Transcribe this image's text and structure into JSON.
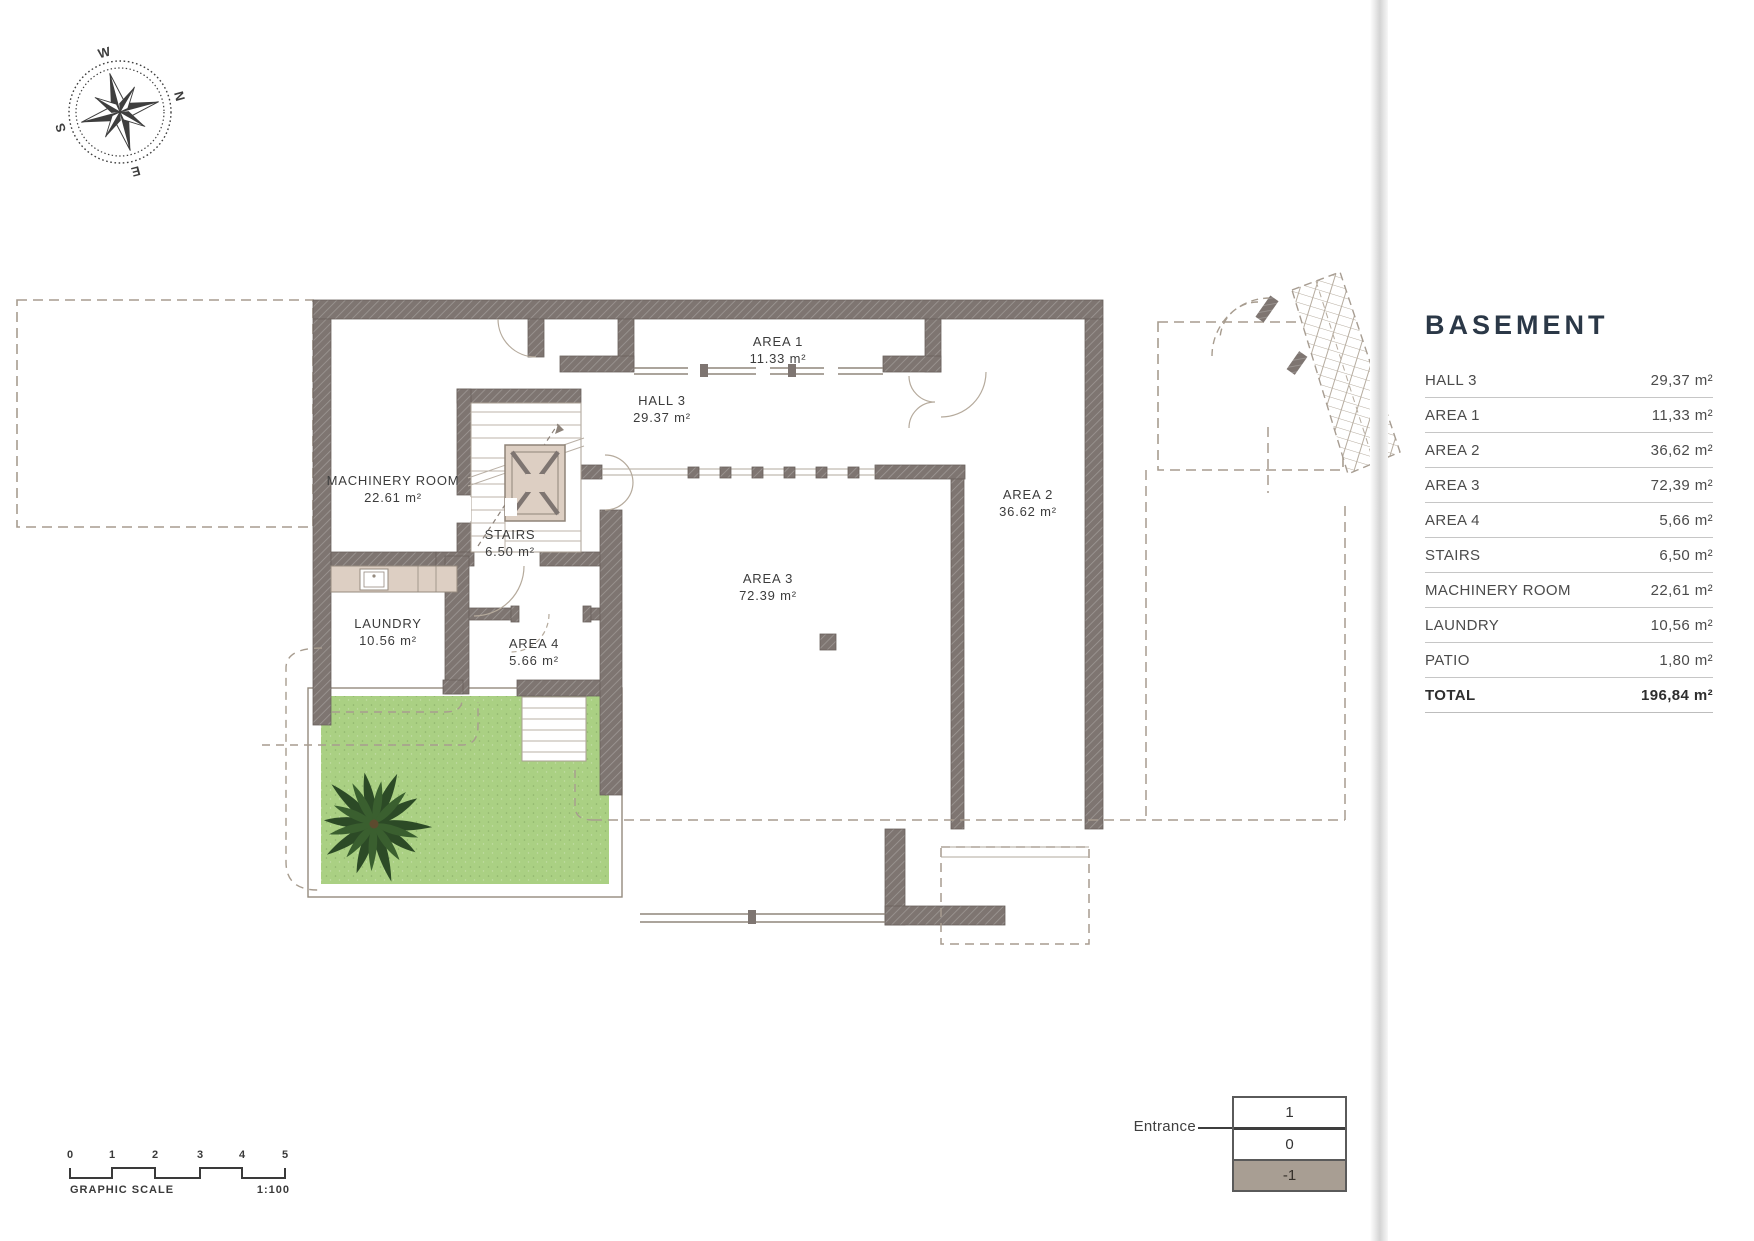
{
  "compass": {
    "n": "N",
    "e": "E",
    "s": "S",
    "w": "W"
  },
  "plan": {
    "rooms": [
      {
        "id": "machinery",
        "name": "MACHINERY ROOM",
        "area": "22.61 m²"
      },
      {
        "id": "hall3",
        "name": "HALL 3",
        "area": "29.37 m²"
      },
      {
        "id": "area1",
        "name": "AREA 1",
        "area": "11.33 m²"
      },
      {
        "id": "area2",
        "name": "AREA 2",
        "area": "36.62 m²"
      },
      {
        "id": "area3",
        "name": "AREA 3",
        "area": "72.39 m²"
      },
      {
        "id": "area4",
        "name": "AREA 4",
        "area": "5.66 m²"
      },
      {
        "id": "stairs",
        "name": "STAIRS",
        "area": "6.50 m²"
      },
      {
        "id": "laundry",
        "name": "LAUNDRY",
        "area": "10.56 m²"
      }
    ]
  },
  "legend": {
    "title": "BASEMENT",
    "rows": [
      {
        "label": "HALL 3",
        "value": "29,37 m²"
      },
      {
        "label": "AREA 1",
        "value": "11,33 m²"
      },
      {
        "label": "AREA 2",
        "value": "36,62 m²"
      },
      {
        "label": "AREA 3",
        "value": "72,39 m²"
      },
      {
        "label": "AREA 4",
        "value": "5,66 m²"
      },
      {
        "label": "STAIRS",
        "value": "6,50 m²"
      },
      {
        "label": "MACHINERY ROOM",
        "value": "22,61 m²"
      },
      {
        "label": "LAUNDRY",
        "value": "10,56 m²"
      },
      {
        "label": "PATIO",
        "value": "1,80 m²"
      }
    ],
    "total": {
      "label": "TOTAL",
      "value": "196,84 m²"
    }
  },
  "scale_bar": {
    "ticks": [
      "0",
      "1",
      "2",
      "3",
      "4",
      "5"
    ],
    "label": "GRAPHIC SCALE",
    "ratio": "1:100"
  },
  "level_indicator": {
    "label": "Entrance",
    "levels": [
      "1",
      "0",
      "-1"
    ],
    "current_level": "-1"
  },
  "colors": {
    "wall": "#7e7571",
    "lawn_green": "#aad083",
    "beige": "#ddcfc3",
    "title_navy": "#2b3847",
    "level_highlight": "#a89e93"
  }
}
